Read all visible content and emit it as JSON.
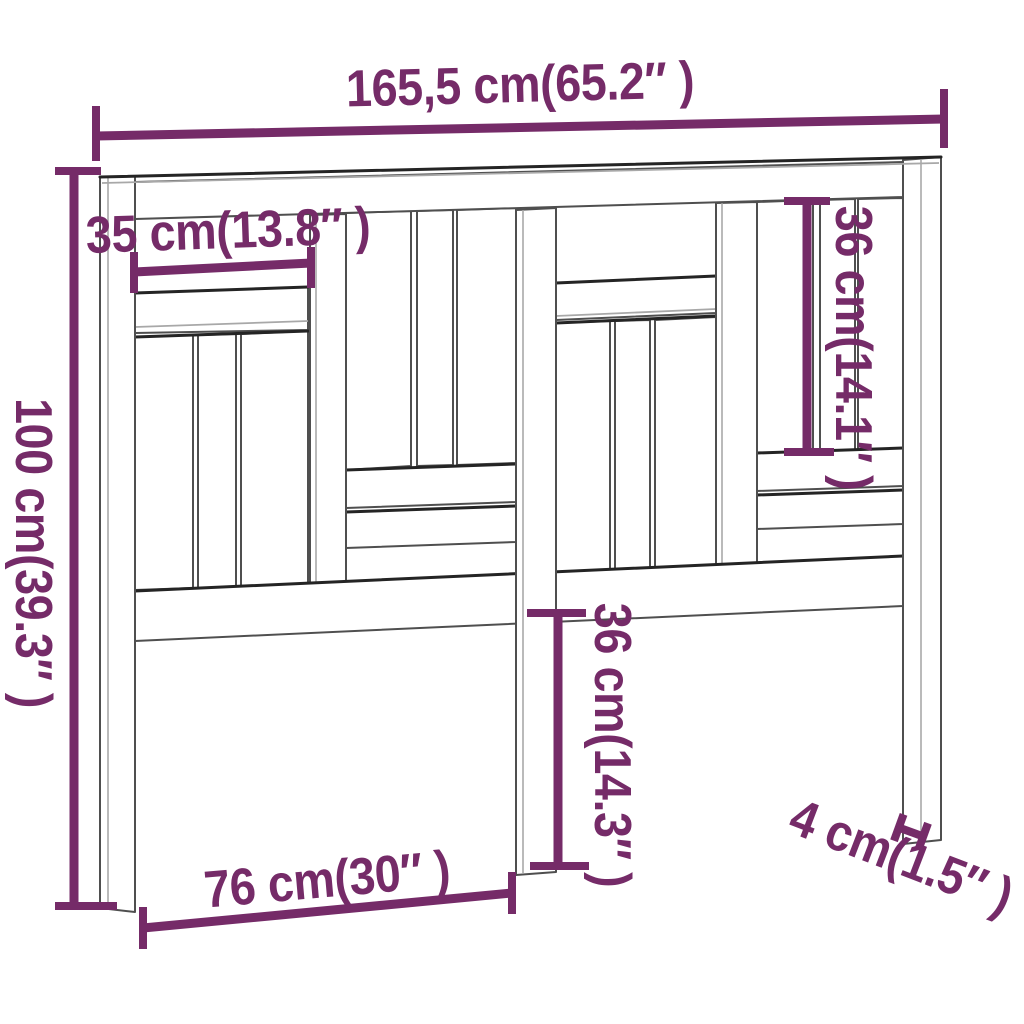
{
  "colors": {
    "accent": "#752B68",
    "line-dark": "#4F4F4F",
    "line-light": "#A8A8A8",
    "line-heavy": "#242424",
    "background": "#FFFFFF"
  },
  "dimensions": {
    "total_width": "165,5 cm(65.2″ )",
    "total_height": "100 cm(39.3″ )",
    "upper_left_opening_width": "35 cm(13.8″ )",
    "right_slat_section_height": "36 cm(14.1″ )",
    "center_leg_height": "36 cm(14.3″ )",
    "leg_spacing": "76 cm(30″ )",
    "leg_thickness": "4 cm(1.5″ )"
  }
}
